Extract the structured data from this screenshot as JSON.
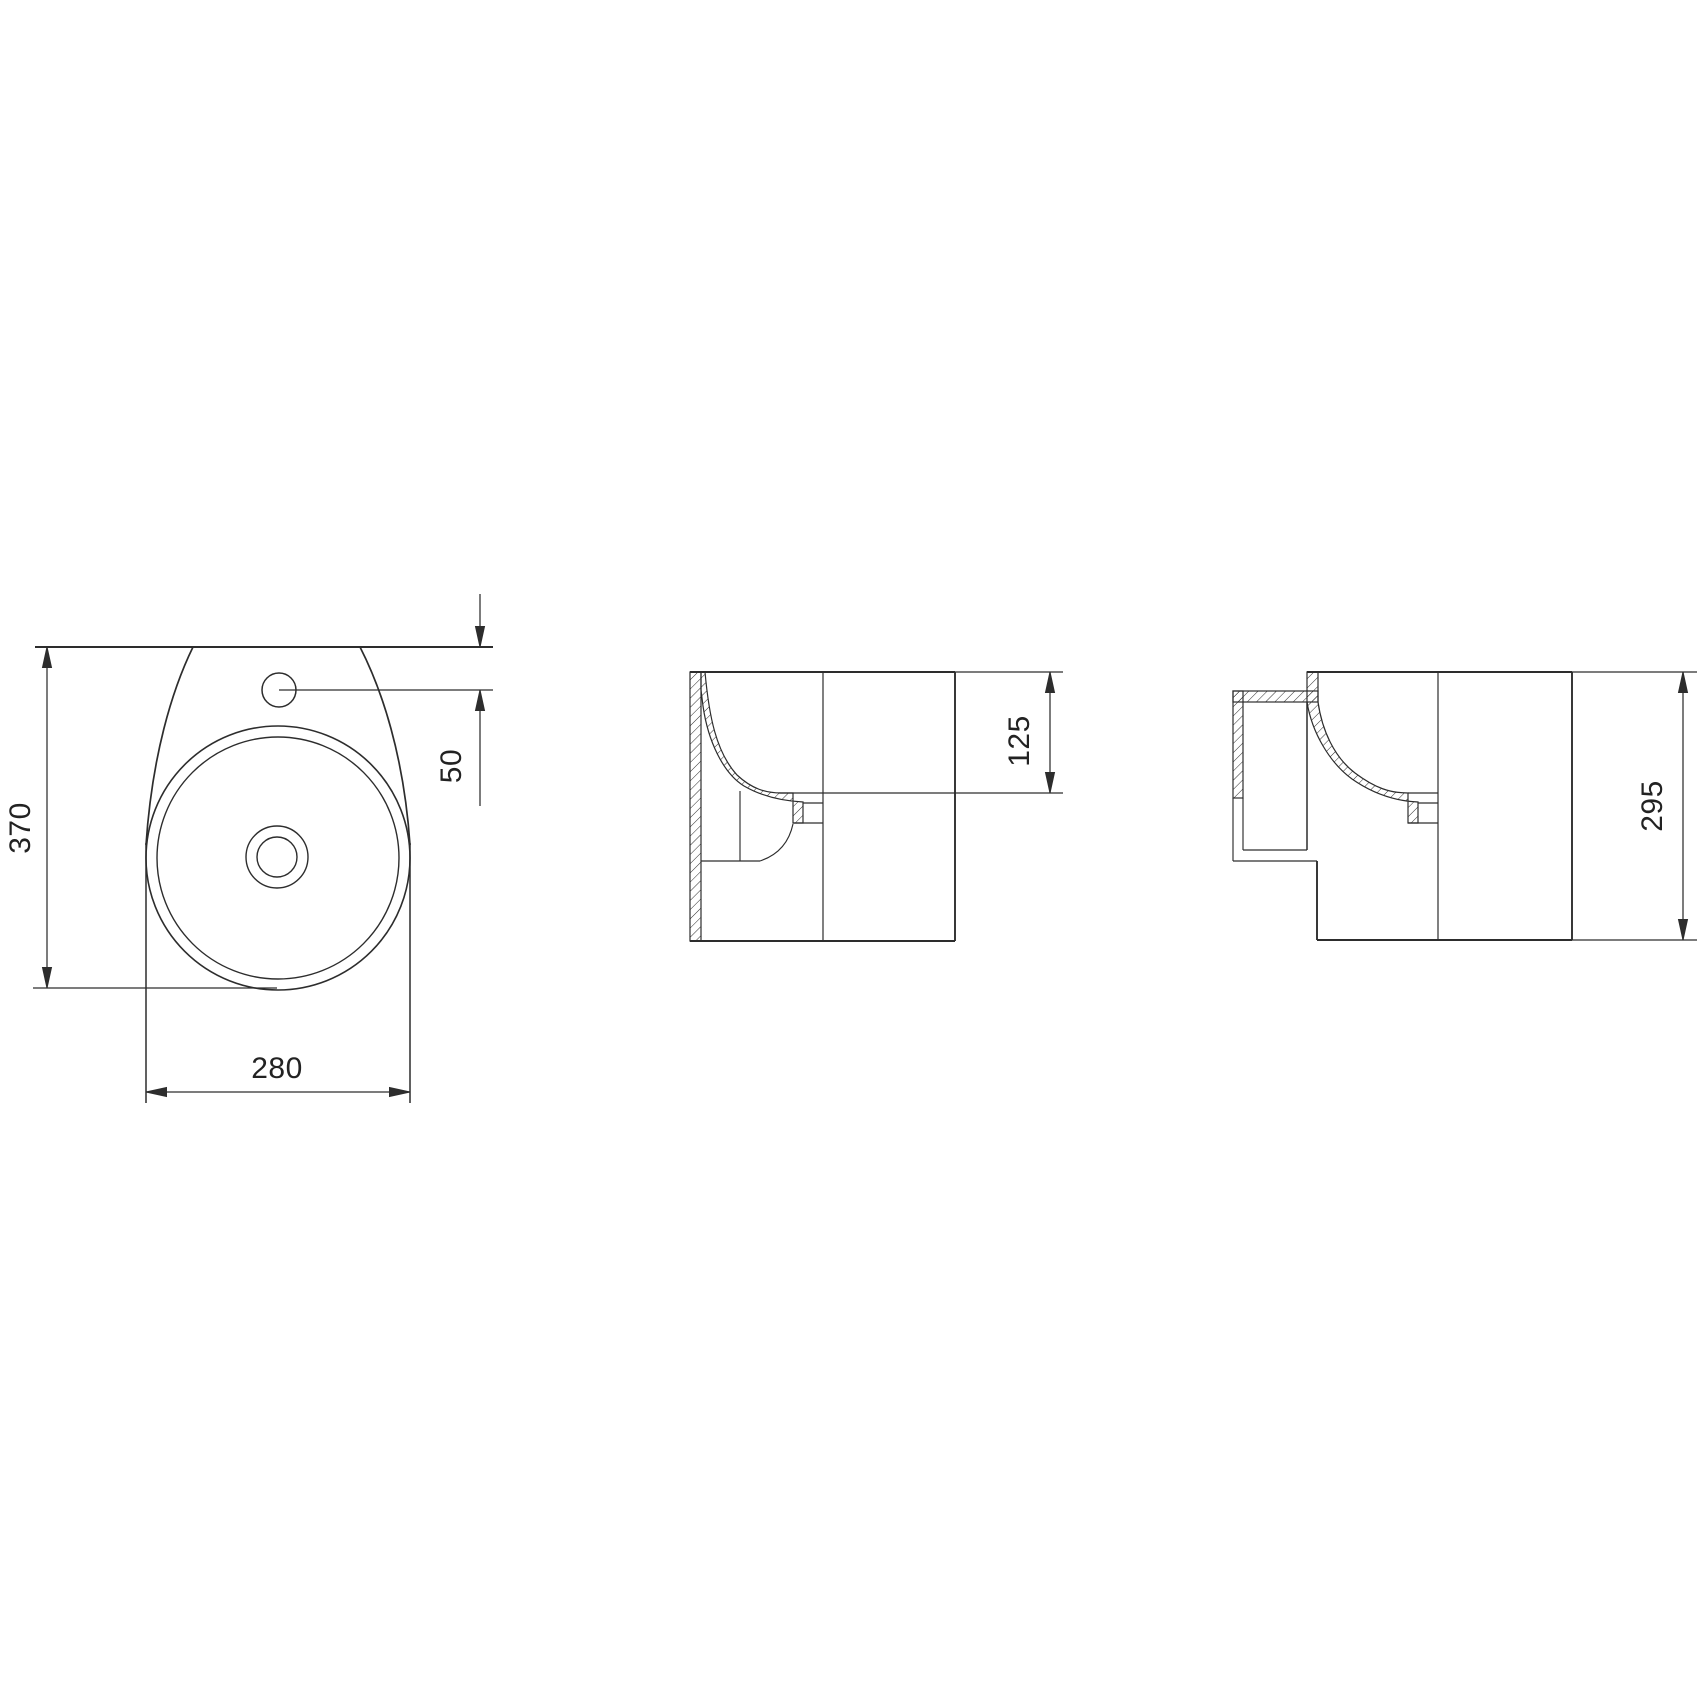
{
  "page": {
    "background_color": "#ffffff"
  },
  "drawing": {
    "subject": "wall-hung washbasin technical dimension drawing, three orthographic views",
    "line_color": "#2d2d2d",
    "hatch_style": "diagonal-45",
    "views": [
      {
        "id": "top-view",
        "label": "plan view with basin rim, drain and faucet hole"
      },
      {
        "id": "side-section-view",
        "label": "side cross-section through bowl and drain"
      },
      {
        "id": "corner-section-view",
        "label": "corner cross-section with mounting ledge"
      }
    ],
    "dimensions": {
      "depth_mm": "370",
      "faucet_offset_mm": "50",
      "width_mm": "280",
      "rim_to_ledge_mm": "125",
      "overall_height_mm": "295"
    }
  }
}
